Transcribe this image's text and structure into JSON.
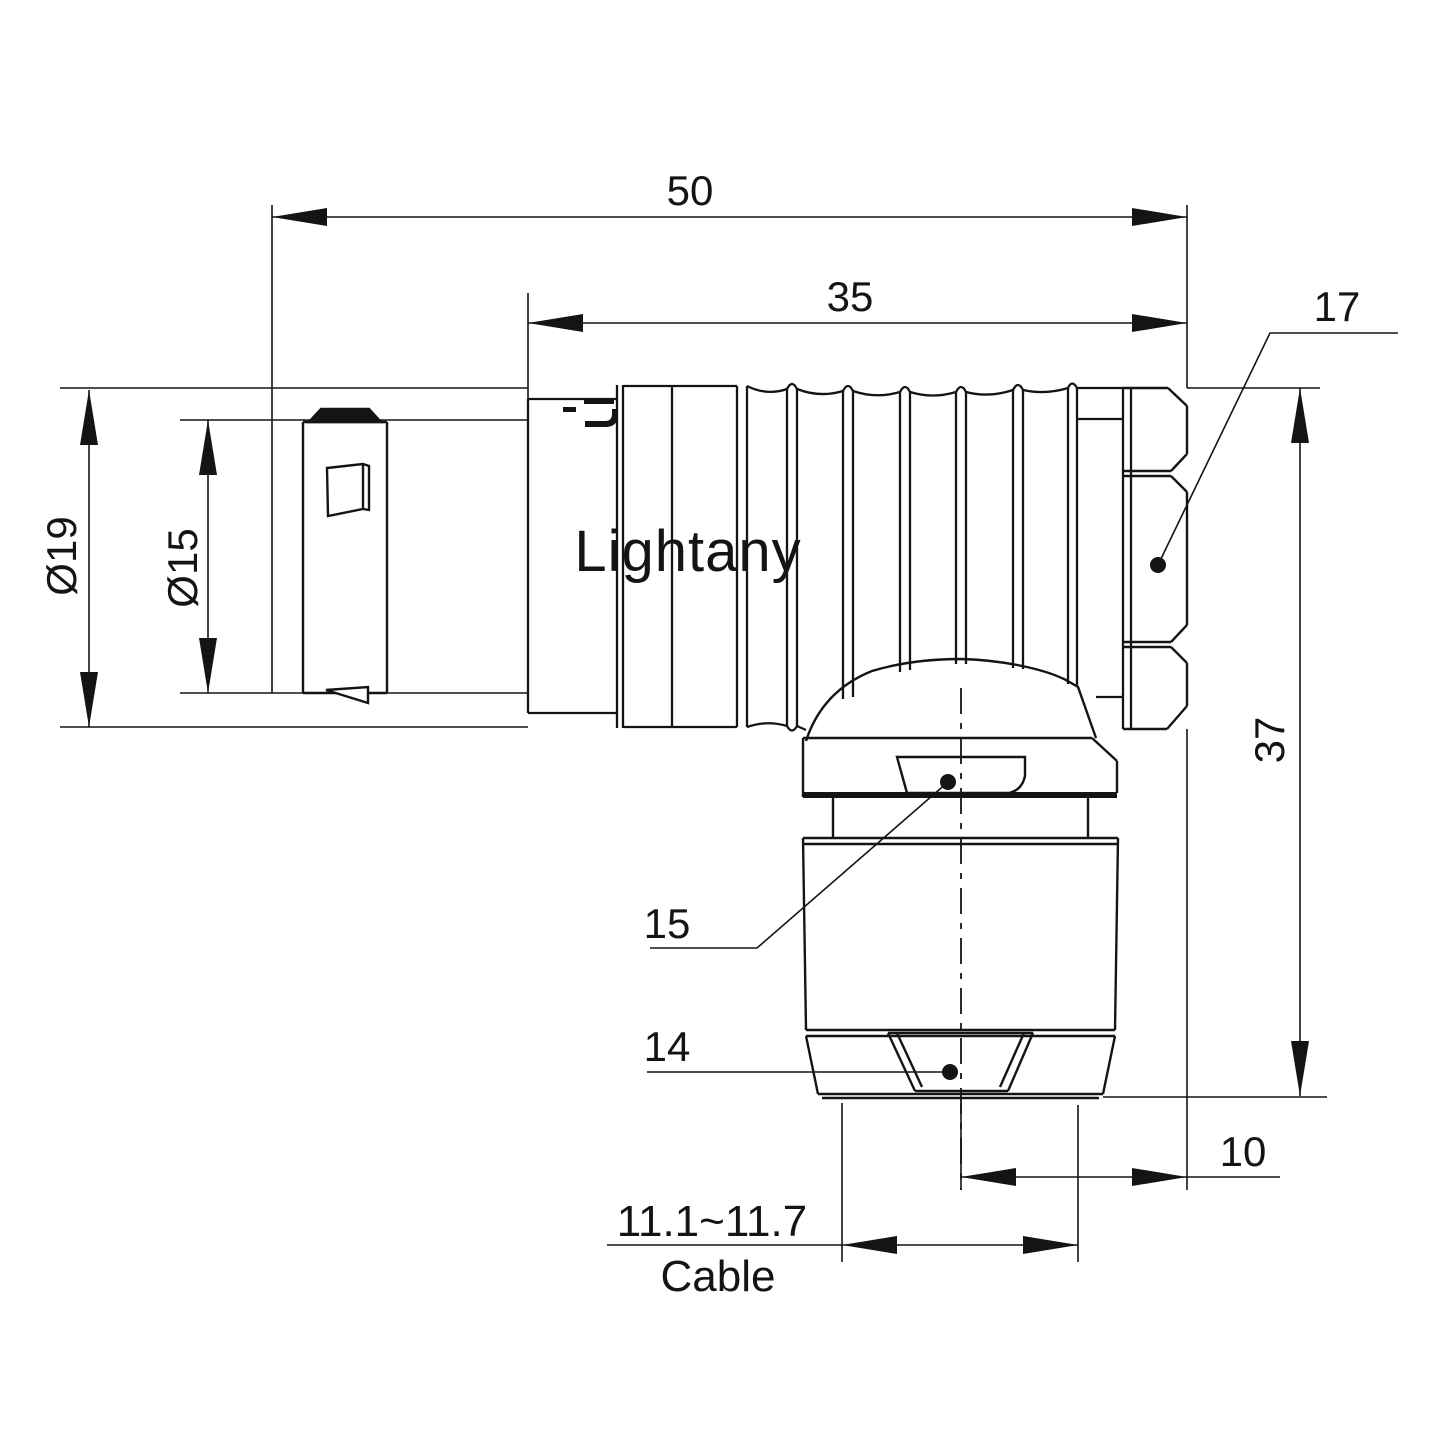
{
  "drawing": {
    "watermark": "Lightany",
    "colors": {
      "line": "#141414",
      "watermark": "#f6d6d6",
      "background": "#ffffff"
    },
    "dimensions": {
      "overall_length": "50",
      "shell_length": "35",
      "outer_diameter": "Ø19",
      "inner_diameter": "Ø15",
      "height": "37",
      "nut_offset": "10",
      "cable_clamp_range": "11.1~11.7",
      "cable_word": "Cable"
    },
    "part_labels": {
      "coupling_nut": "17",
      "collar_window": "15",
      "cable_nut": "14"
    }
  }
}
